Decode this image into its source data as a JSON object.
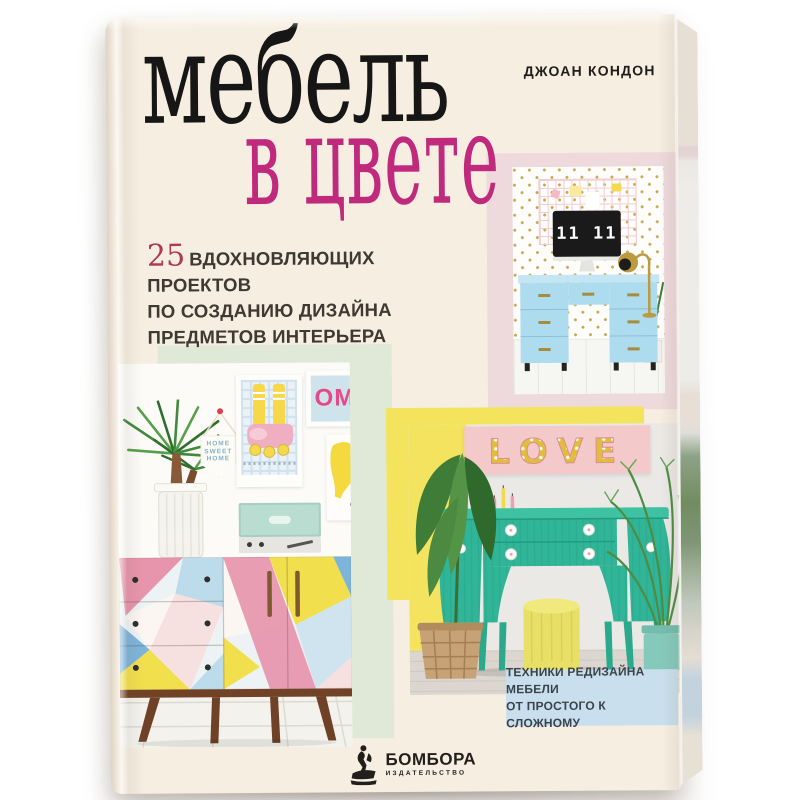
{
  "palette": {
    "cover_cream": "#f6eee1",
    "title_black": "#161616",
    "title_magenta": "#c02a7d",
    "subtitle_crimson": "#ad3a52",
    "text_dark": "#3e3a33",
    "block_pink": "#eedadc",
    "block_mint": "#e0e8d8",
    "block_yellow": "#f4e35c",
    "badge_blue": "#c9dfed",
    "desk_blue": "#aedcef",
    "console_teal": "#31b598",
    "pouf_yellow": "#e8e066",
    "marquee_pink": "#f3c9ca",
    "marquee_yellow": "#e2bd3b"
  },
  "book": {
    "author": "ДЖОАН КОНДОН",
    "title": {
      "line1": "мебель",
      "line2": "в цвете"
    },
    "subtitle": {
      "number": "25",
      "lines": [
        "ВДОХНОВЛЯЮЩИХ ПРОЕКТОВ",
        "ПО СОЗДАНИЮ ДИЗАЙНА",
        "ПРЕДМЕТОВ ИНТЕРЬЕРА"
      ]
    },
    "badge": {
      "line1": "ТЕХНИКИ РЕДИЗАЙНА МЕБЕЛИ",
      "line2": "ОТ ПРОСТОГО К СЛОЖНОМУ"
    },
    "publisher": {
      "name": "БОМБОРА",
      "tagline": "ИЗДАТЕЛЬСТВО",
      "icon": "surfer-on-wave-icon"
    }
  },
  "photos": {
    "desk_scene": {
      "clock_text": "11 11"
    },
    "gallery_scene": {
      "pennant_lines": [
        "HOME",
        "SWEET",
        "HOME"
      ],
      "om_poster_text": "OM"
    },
    "console_scene": {
      "marquee_text": "LOVE"
    }
  }
}
